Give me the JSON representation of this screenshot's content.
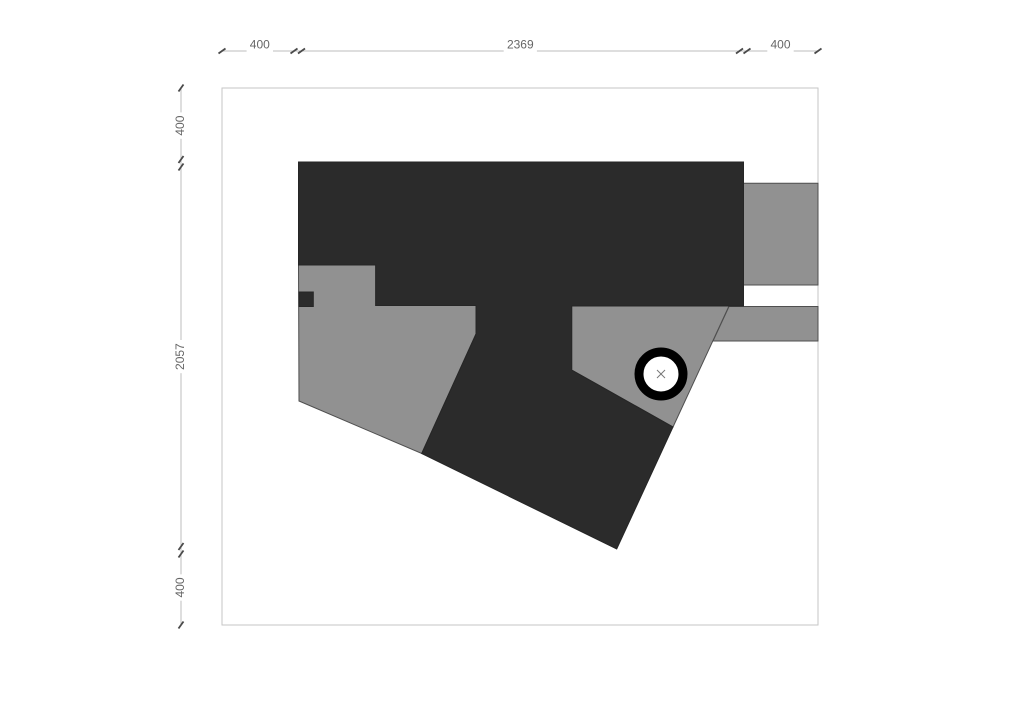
{
  "colors": {
    "background": "#ffffff",
    "dark_fill": "#2b2b2b",
    "dark_stroke": "#262626",
    "gray_fill": "#919191",
    "shape_outline": "#4f4f4f",
    "border_stroke": "#c6c6c6",
    "dim_line": "#bdbdbd",
    "dim_tick": "#4a4a4a",
    "dim_text": "#666666",
    "circle_ring": "#000000",
    "circle_fill": "#ffffff",
    "center_mark": "#777777"
  },
  "drawing": {
    "border": {
      "x": 222,
      "y": 88,
      "width": 596,
      "height": 537
    },
    "shapes": [
      {
        "name": "left-gray-terrace",
        "fill": "gray_fill",
        "stroke": "shape_outline",
        "points": [
          [
            298.5,
            265
          ],
          [
            375.7,
            265
          ],
          [
            375.7,
            305.5
          ],
          [
            476,
            305.5
          ],
          [
            476,
            334
          ],
          [
            421.7,
            453.5
          ],
          [
            299,
            401
          ]
        ]
      },
      {
        "name": "right-gray-terrace",
        "fill": "gray_fill",
        "stroke": "shape_outline",
        "points": [
          [
            571.7,
            305.5
          ],
          [
            729,
            306
          ],
          [
            673,
            427
          ],
          [
            571.7,
            370
          ]
        ]
      },
      {
        "name": "right-wing-upper",
        "fill": "gray_fill",
        "stroke": "shape_outline",
        "points": [
          [
            743.5,
            183.3
          ],
          [
            818,
            183.3
          ],
          [
            818,
            285
          ],
          [
            743.5,
            285
          ]
        ]
      },
      {
        "name": "right-wing-lower",
        "fill": "gray_fill",
        "stroke": "shape_outline",
        "points": [
          [
            729,
            306.5
          ],
          [
            818,
            306.5
          ],
          [
            818,
            341
          ],
          [
            713,
            341
          ]
        ]
      },
      {
        "name": "main-dark-building",
        "fill": "dark_fill",
        "stroke": "dark_stroke",
        "points": [
          [
            298.5,
            162
          ],
          [
            743.5,
            162
          ],
          [
            743.5,
            306
          ],
          [
            571.7,
            306
          ],
          [
            571.7,
            370
          ],
          [
            673,
            427
          ],
          [
            616.7,
            549
          ],
          [
            421.7,
            453.5
          ],
          [
            476,
            334
          ],
          [
            476,
            305.5
          ],
          [
            375.7,
            305.5
          ],
          [
            375.7,
            265
          ],
          [
            298.5,
            265
          ]
        ]
      },
      {
        "name": "small-dark-block",
        "fill": "dark_fill",
        "stroke": "dark_stroke",
        "points": [
          [
            299,
            292
          ],
          [
            313.3,
            292
          ],
          [
            313.3,
            306.5
          ],
          [
            299,
            306.5
          ]
        ]
      }
    ],
    "column": {
      "cx": 661,
      "cy": 374,
      "ring_radius": 22,
      "ring_width": 9,
      "cross_arm": 4
    }
  },
  "dimensions": {
    "top": {
      "orientation": "horizontal",
      "line": {
        "x1": 222,
        "x2": 818,
        "y": 51
      },
      "ticks": [
        222,
        294,
        301.5,
        739.5,
        747,
        818
      ],
      "segments": [
        {
          "label": "400",
          "mid": 259.8
        },
        {
          "label": "2369",
          "mid": 520.3
        },
        {
          "label": "400",
          "mid": 780.5
        }
      ]
    },
    "left": {
      "orientation": "vertical",
      "line": {
        "y1": 88,
        "y2": 625,
        "x": 181
      },
      "ticks": [
        88,
        159.5,
        167,
        546.5,
        554,
        625
      ],
      "segments": [
        {
          "label": "400",
          "mid": 125.6
        },
        {
          "label": "2057",
          "mid": 356.6
        },
        {
          "label": "400",
          "mid": 587.5
        }
      ]
    }
  }
}
